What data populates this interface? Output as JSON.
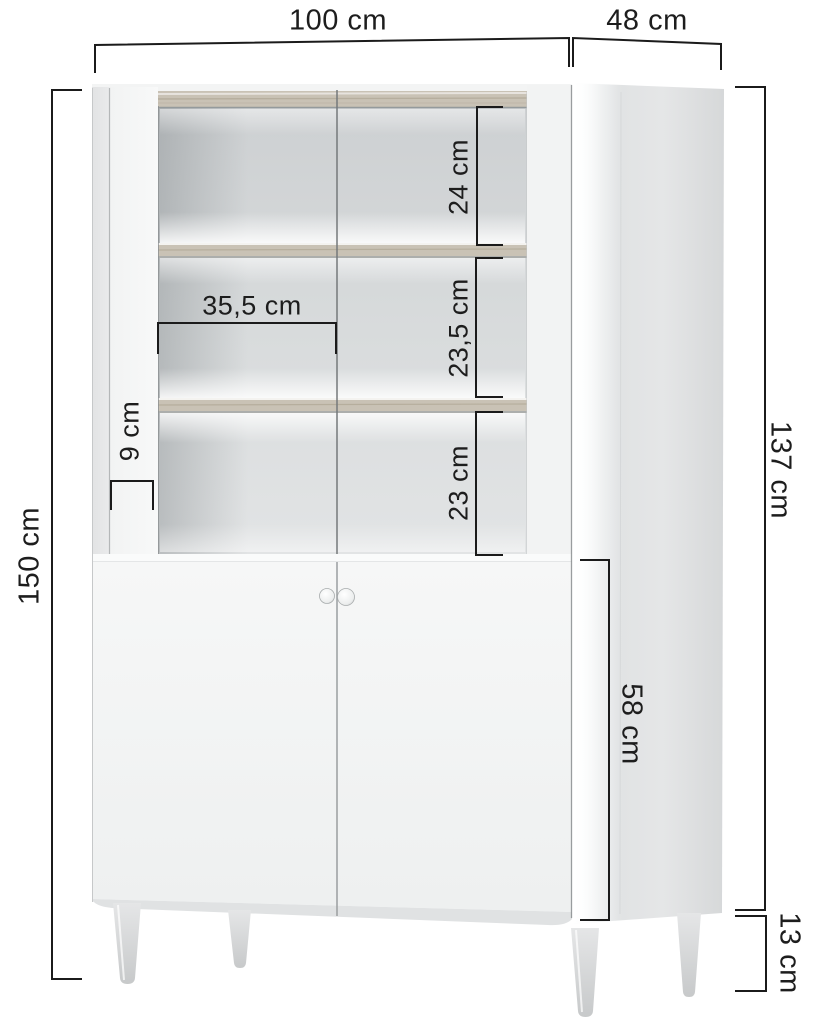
{
  "figure": {
    "kind": "furniture dimension diagram",
    "subject": "two-door display cabinet with lighted shelves and wooden legs"
  },
  "dims": {
    "width": "100 cm",
    "depth": "48 cm",
    "total_height": "150 cm",
    "body_height": "137 cm",
    "lower_door_height": "58 cm",
    "leg_height": "13 cm",
    "top_compartment_height": "24 cm",
    "middle_compartment_height": "23,5 cm",
    "bottom_compartment_height": "23 cm",
    "inner_shelf_width": "35,5 cm",
    "front_edge_width": "9 cm"
  },
  "colors": {
    "dimension_line": "#1b1b1b",
    "label_text": "#1d1d1d",
    "cabinet_front": "#f4f5f5",
    "cabinet_side": "#e2e4e5",
    "interior_back": "#d5d8d9",
    "wood_shelf": "#c9c2b5",
    "led_glow": "#ffffff",
    "background": "#ffffff"
  }
}
